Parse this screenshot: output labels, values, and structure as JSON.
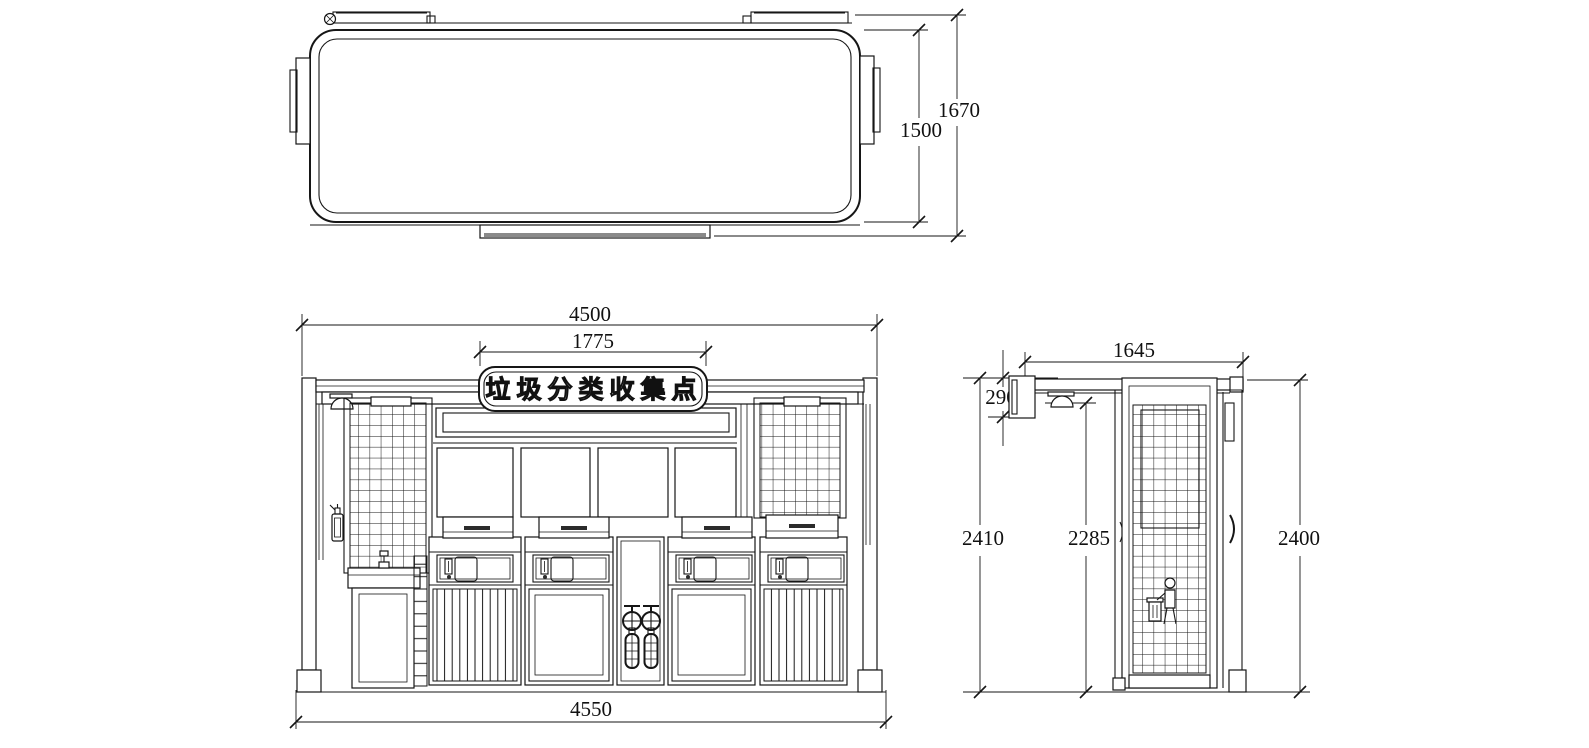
{
  "drawing_title": "垃圾分类收集点 waste collection station - three view technical drawing",
  "sign": {
    "text": "垃圾分类收集点"
  },
  "dimensions": {
    "plan": {
      "inner_width": "1500",
      "overall_width": "1670"
    },
    "front": {
      "overall_top": "4500",
      "sign_width": "1775",
      "overall_bottom": "4550"
    },
    "side": {
      "overall_depth": "1645",
      "sign_depth": "290",
      "height_left": "2410",
      "height_mid": "2285",
      "height_right": "2400"
    }
  },
  "colors": {
    "line": "#161616",
    "background": "#ffffff",
    "shade": "#8a8a8a",
    "dark_accent": "#2b2b2b"
  }
}
